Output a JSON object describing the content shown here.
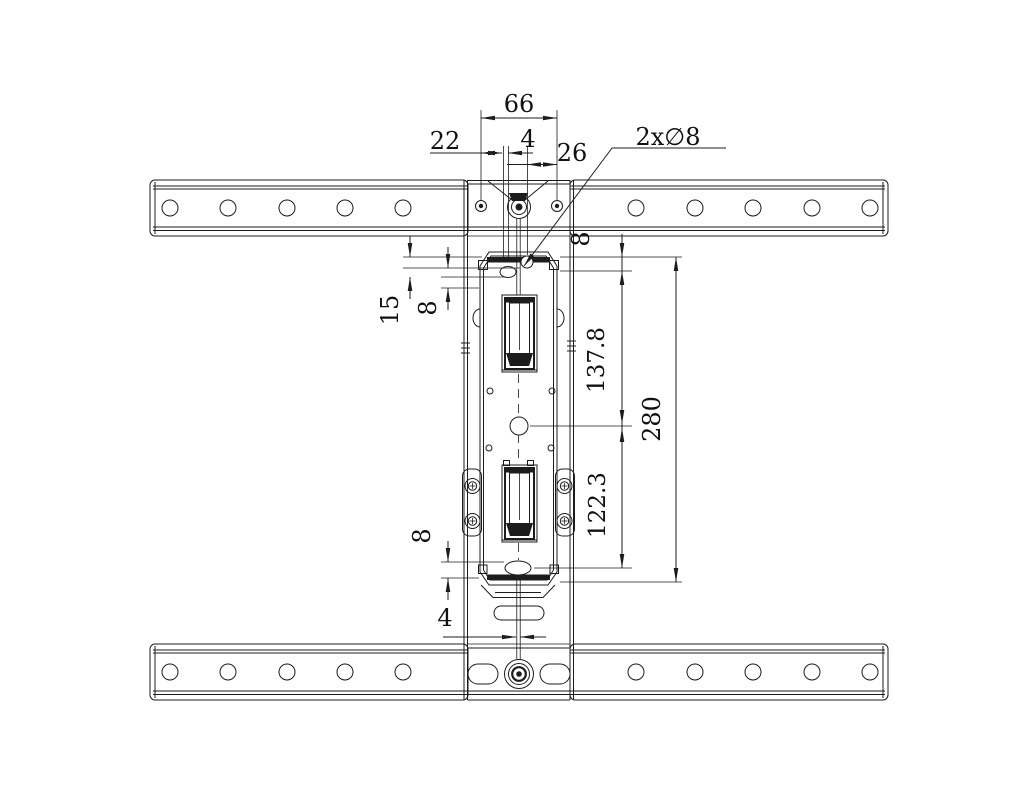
{
  "drawing": {
    "labels": {
      "top_width": "66",
      "top_left_offset": "22",
      "top_slot_width": "4",
      "top_right_offset": "26",
      "holes_callout": "2x∅8",
      "left_edge_to_hole": "15",
      "left_hole_offset": "8",
      "right_rail_to_hole": "8",
      "hole_to_center": "137.8",
      "center_to_bottom_hole": "122.3",
      "overall_height": "280",
      "bottom_hole_to_edge": "8",
      "bottom_slot_width": "4"
    },
    "colors": {
      "line": "#1c1c1c",
      "background": "#ffffff"
    }
  }
}
